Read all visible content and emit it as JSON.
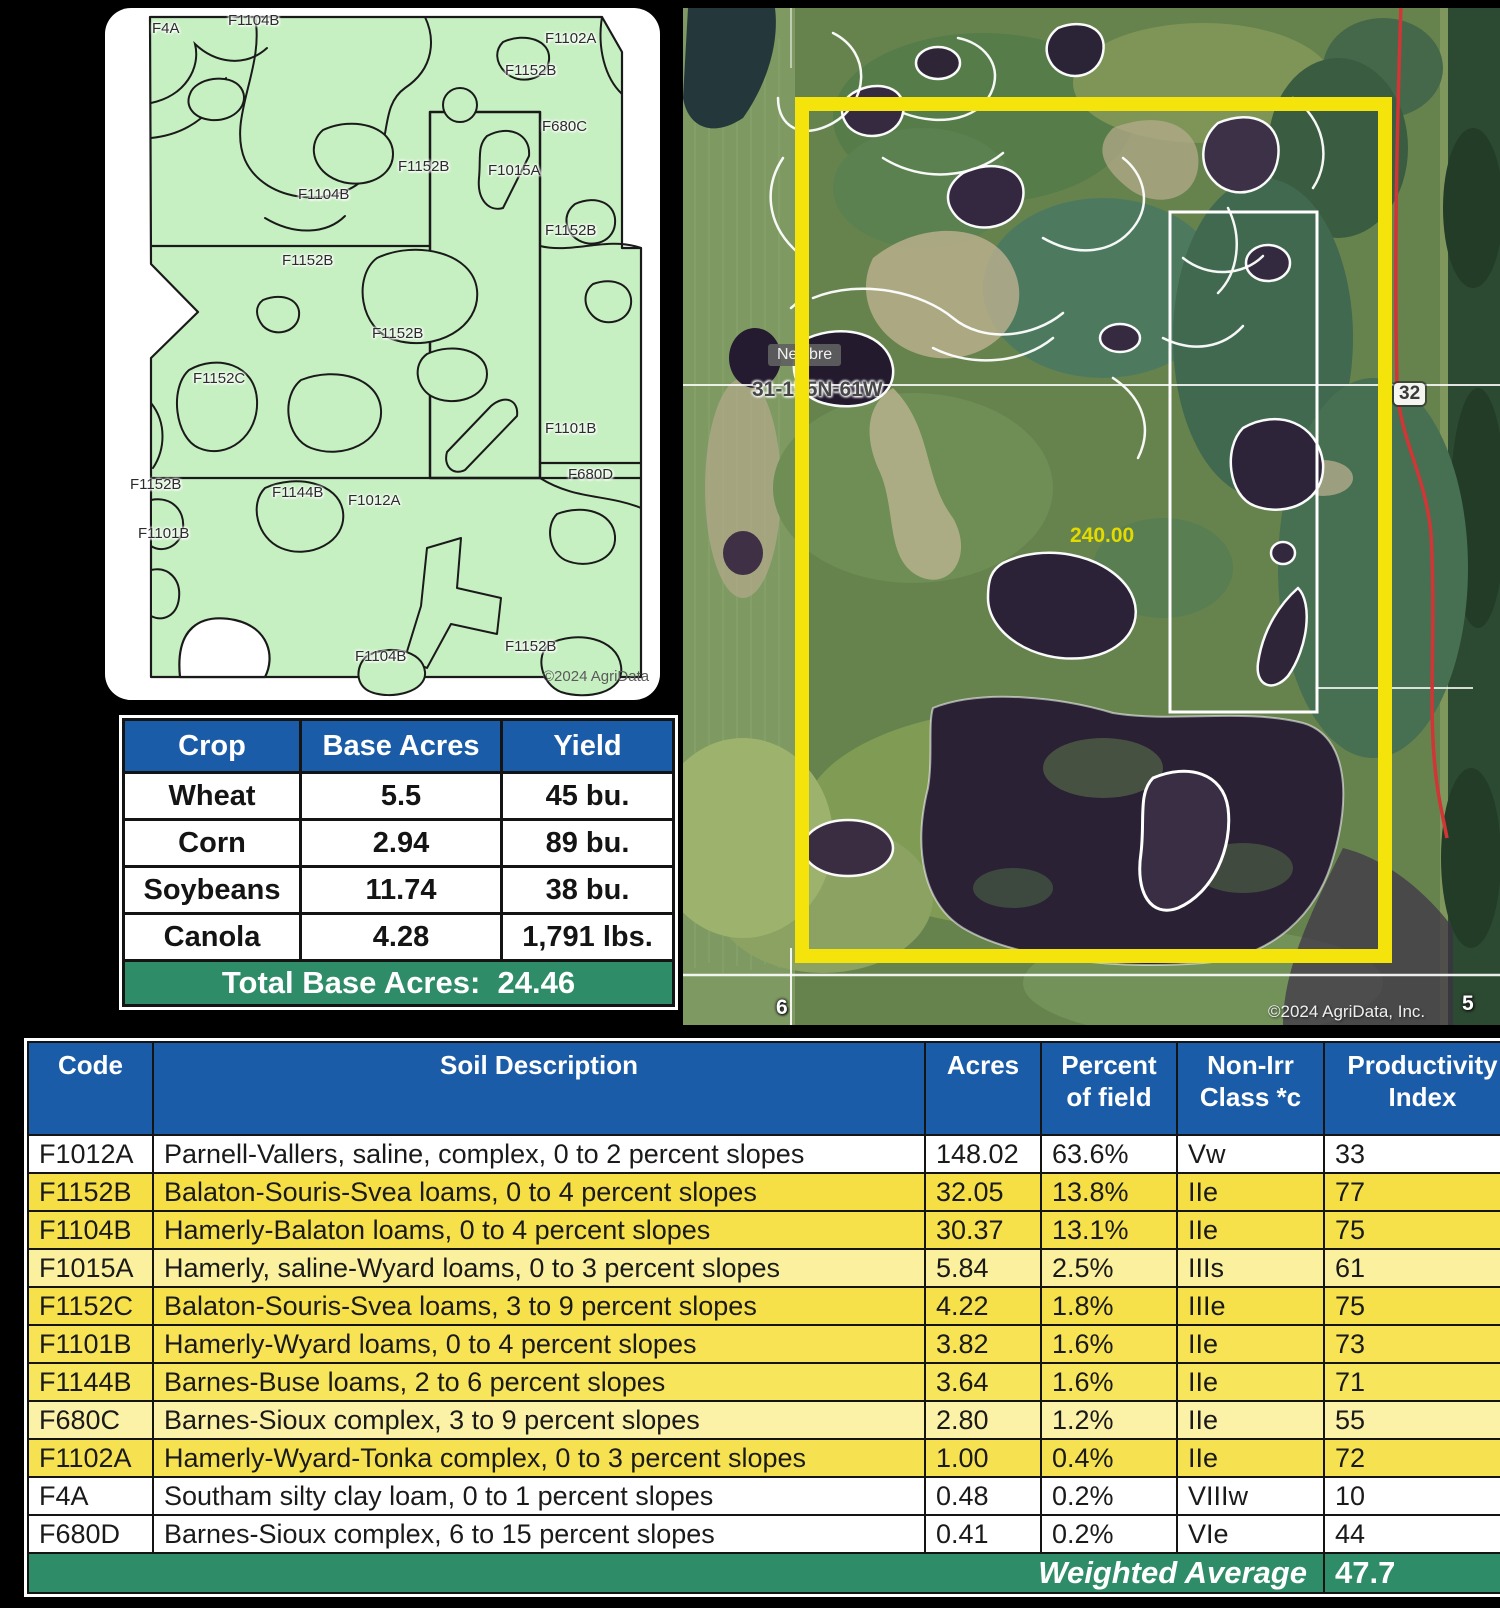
{
  "map_card": {
    "copyright": "©2024 AgriData",
    "labels": [
      {
        "text": "F4A",
        "x": 47,
        "y": 12
      },
      {
        "text": "F1104B",
        "x": 123,
        "y": 4
      },
      {
        "text": "F1102A",
        "x": 440,
        "y": 22
      },
      {
        "text": "F1152B",
        "x": 400,
        "y": 54
      },
      {
        "text": "F680C",
        "x": 437,
        "y": 110
      },
      {
        "text": "F1152B",
        "x": 293,
        "y": 150
      },
      {
        "text": "F1015A",
        "x": 383,
        "y": 154
      },
      {
        "text": "F1104B",
        "x": 193,
        "y": 178
      },
      {
        "text": "F1152B",
        "x": 440,
        "y": 214
      },
      {
        "text": "F1152B",
        "x": 177,
        "y": 244
      },
      {
        "text": "F1152B",
        "x": 267,
        "y": 317
      },
      {
        "text": "F1152C",
        "x": 88,
        "y": 362
      },
      {
        "text": "F1101B",
        "x": 440,
        "y": 412
      },
      {
        "text": "F680D",
        "x": 463,
        "y": 458
      },
      {
        "text": "F1152B",
        "x": 25,
        "y": 468
      },
      {
        "text": "F1144B",
        "x": 167,
        "y": 476
      },
      {
        "text": "F1012A",
        "x": 243,
        "y": 484
      },
      {
        "text": "F1101B",
        "x": 33,
        "y": 517
      },
      {
        "text": "F1152B",
        "x": 400,
        "y": 630
      },
      {
        "text": "F1104B",
        "x": 250,
        "y": 640
      }
    ]
  },
  "aerial": {
    "place_label": "Newbre",
    "section_label": "31-155N-61W",
    "acres_label": "240.00",
    "section_right": "32",
    "section_bottom_left": "6",
    "section_bottom_right": "5",
    "copyright": "©2024 AgriData, Inc.",
    "boundary_color": "#F4E40B"
  },
  "crop_table": {
    "headers": [
      "Crop",
      "Base Acres",
      "Yield"
    ],
    "rows": [
      {
        "crop": "Wheat",
        "base_acres": "5.5",
        "yield": "45 bu."
      },
      {
        "crop": "Corn",
        "base_acres": "2.94",
        "yield": "89 bu."
      },
      {
        "crop": "Soybeans",
        "base_acres": "11.74",
        "yield": "38 bu."
      },
      {
        "crop": "Canola",
        "base_acres": "4.28",
        "yield": "1,791 lbs."
      }
    ],
    "total_label": "Total Base Acres:",
    "total_value": "24.46"
  },
  "soil_table": {
    "headers": [
      {
        "line1": "Code",
        "line2": ""
      },
      {
        "line1": "Soil Description",
        "line2": ""
      },
      {
        "line1": "Acres",
        "line2": ""
      },
      {
        "line1": "Percent",
        "line2": "of field"
      },
      {
        "line1": "Non-Irr",
        "line2": "Class *c"
      },
      {
        "line1": "Productivity",
        "line2": "Index"
      }
    ],
    "rows": [
      {
        "code": "F1012A",
        "description": "Parnell-Vallers, saline, complex, 0 to 2 percent slopes",
        "acres": "148.02",
        "percent": "63.6%",
        "non_irr_class": "Vw",
        "productivity_index": "33",
        "bg": "#FFFFFF"
      },
      {
        "code": "F1152B",
        "description": "Balaton-Souris-Svea loams, 0 to 4 percent slopes",
        "acres": "32.05",
        "percent": "13.8%",
        "non_irr_class": "IIe",
        "productivity_index": "77",
        "bg": "#F5DF45"
      },
      {
        "code": "F1104B",
        "description": "Hamerly-Balaton loams, 0 to 4 percent slopes",
        "acres": "30.37",
        "percent": "13.1%",
        "non_irr_class": "IIe",
        "productivity_index": "75",
        "bg": "#F6E14B"
      },
      {
        "code": "F1015A",
        "description": "Hamerly, saline-Wyard loams, 0 to 3 percent slopes",
        "acres": "5.84",
        "percent": "2.5%",
        "non_irr_class": "IIIs",
        "productivity_index": "61",
        "bg": "#FAF09E"
      },
      {
        "code": "F1152C",
        "description": "Balaton-Souris-Svea loams, 3 to 9 percent slopes",
        "acres": "4.22",
        "percent": "1.8%",
        "non_irr_class": "IIIe",
        "productivity_index": "75",
        "bg": "#F6E14B"
      },
      {
        "code": "F1101B",
        "description": "Hamerly-Wyard loams, 0 to 4 percent slopes",
        "acres": "3.82",
        "percent": "1.6%",
        "non_irr_class": "IIe",
        "productivity_index": "73",
        "bg": "#F7E353"
      },
      {
        "code": "F1144B",
        "description": "Barnes-Buse loams, 2 to 6 percent slopes",
        "acres": "3.64",
        "percent": "1.6%",
        "non_irr_class": "IIe",
        "productivity_index": "71",
        "bg": "#F7E55C"
      },
      {
        "code": "F680C",
        "description": "Barnes-Sioux complex, 3 to 9 percent slopes",
        "acres": "2.80",
        "percent": "1.2%",
        "non_irr_class": "IIe",
        "productivity_index": "55",
        "bg": "#FBF2A8"
      },
      {
        "code": "F1102A",
        "description": "Hamerly-Wyard-Tonka complex, 0 to 3 percent slopes",
        "acres": "1.00",
        "percent": "0.4%",
        "non_irr_class": "IIe",
        "productivity_index": "72",
        "bg": "#F6E250"
      },
      {
        "code": "F4A",
        "description": "Southam silty clay loam, 0 to 1 percent slopes",
        "acres": "0.48",
        "percent": "0.2%",
        "non_irr_class": "VIIIw",
        "productivity_index": "10",
        "bg": "#FFFFFF"
      },
      {
        "code": "F680D",
        "description": "Barnes-Sioux complex, 6 to 15 percent slopes",
        "acres": "0.41",
        "percent": "0.2%",
        "non_irr_class": "VIe",
        "productivity_index": "44",
        "bg": "#FFFFFF"
      }
    ],
    "footer": {
      "label": "Weighted Average",
      "value": "47.7"
    }
  },
  "colors": {
    "header_blue": "#1B5CA8",
    "total_green": "#2F8C69",
    "map_green": "#C7F0C2",
    "boundary_yellow": "#F4E40B"
  }
}
